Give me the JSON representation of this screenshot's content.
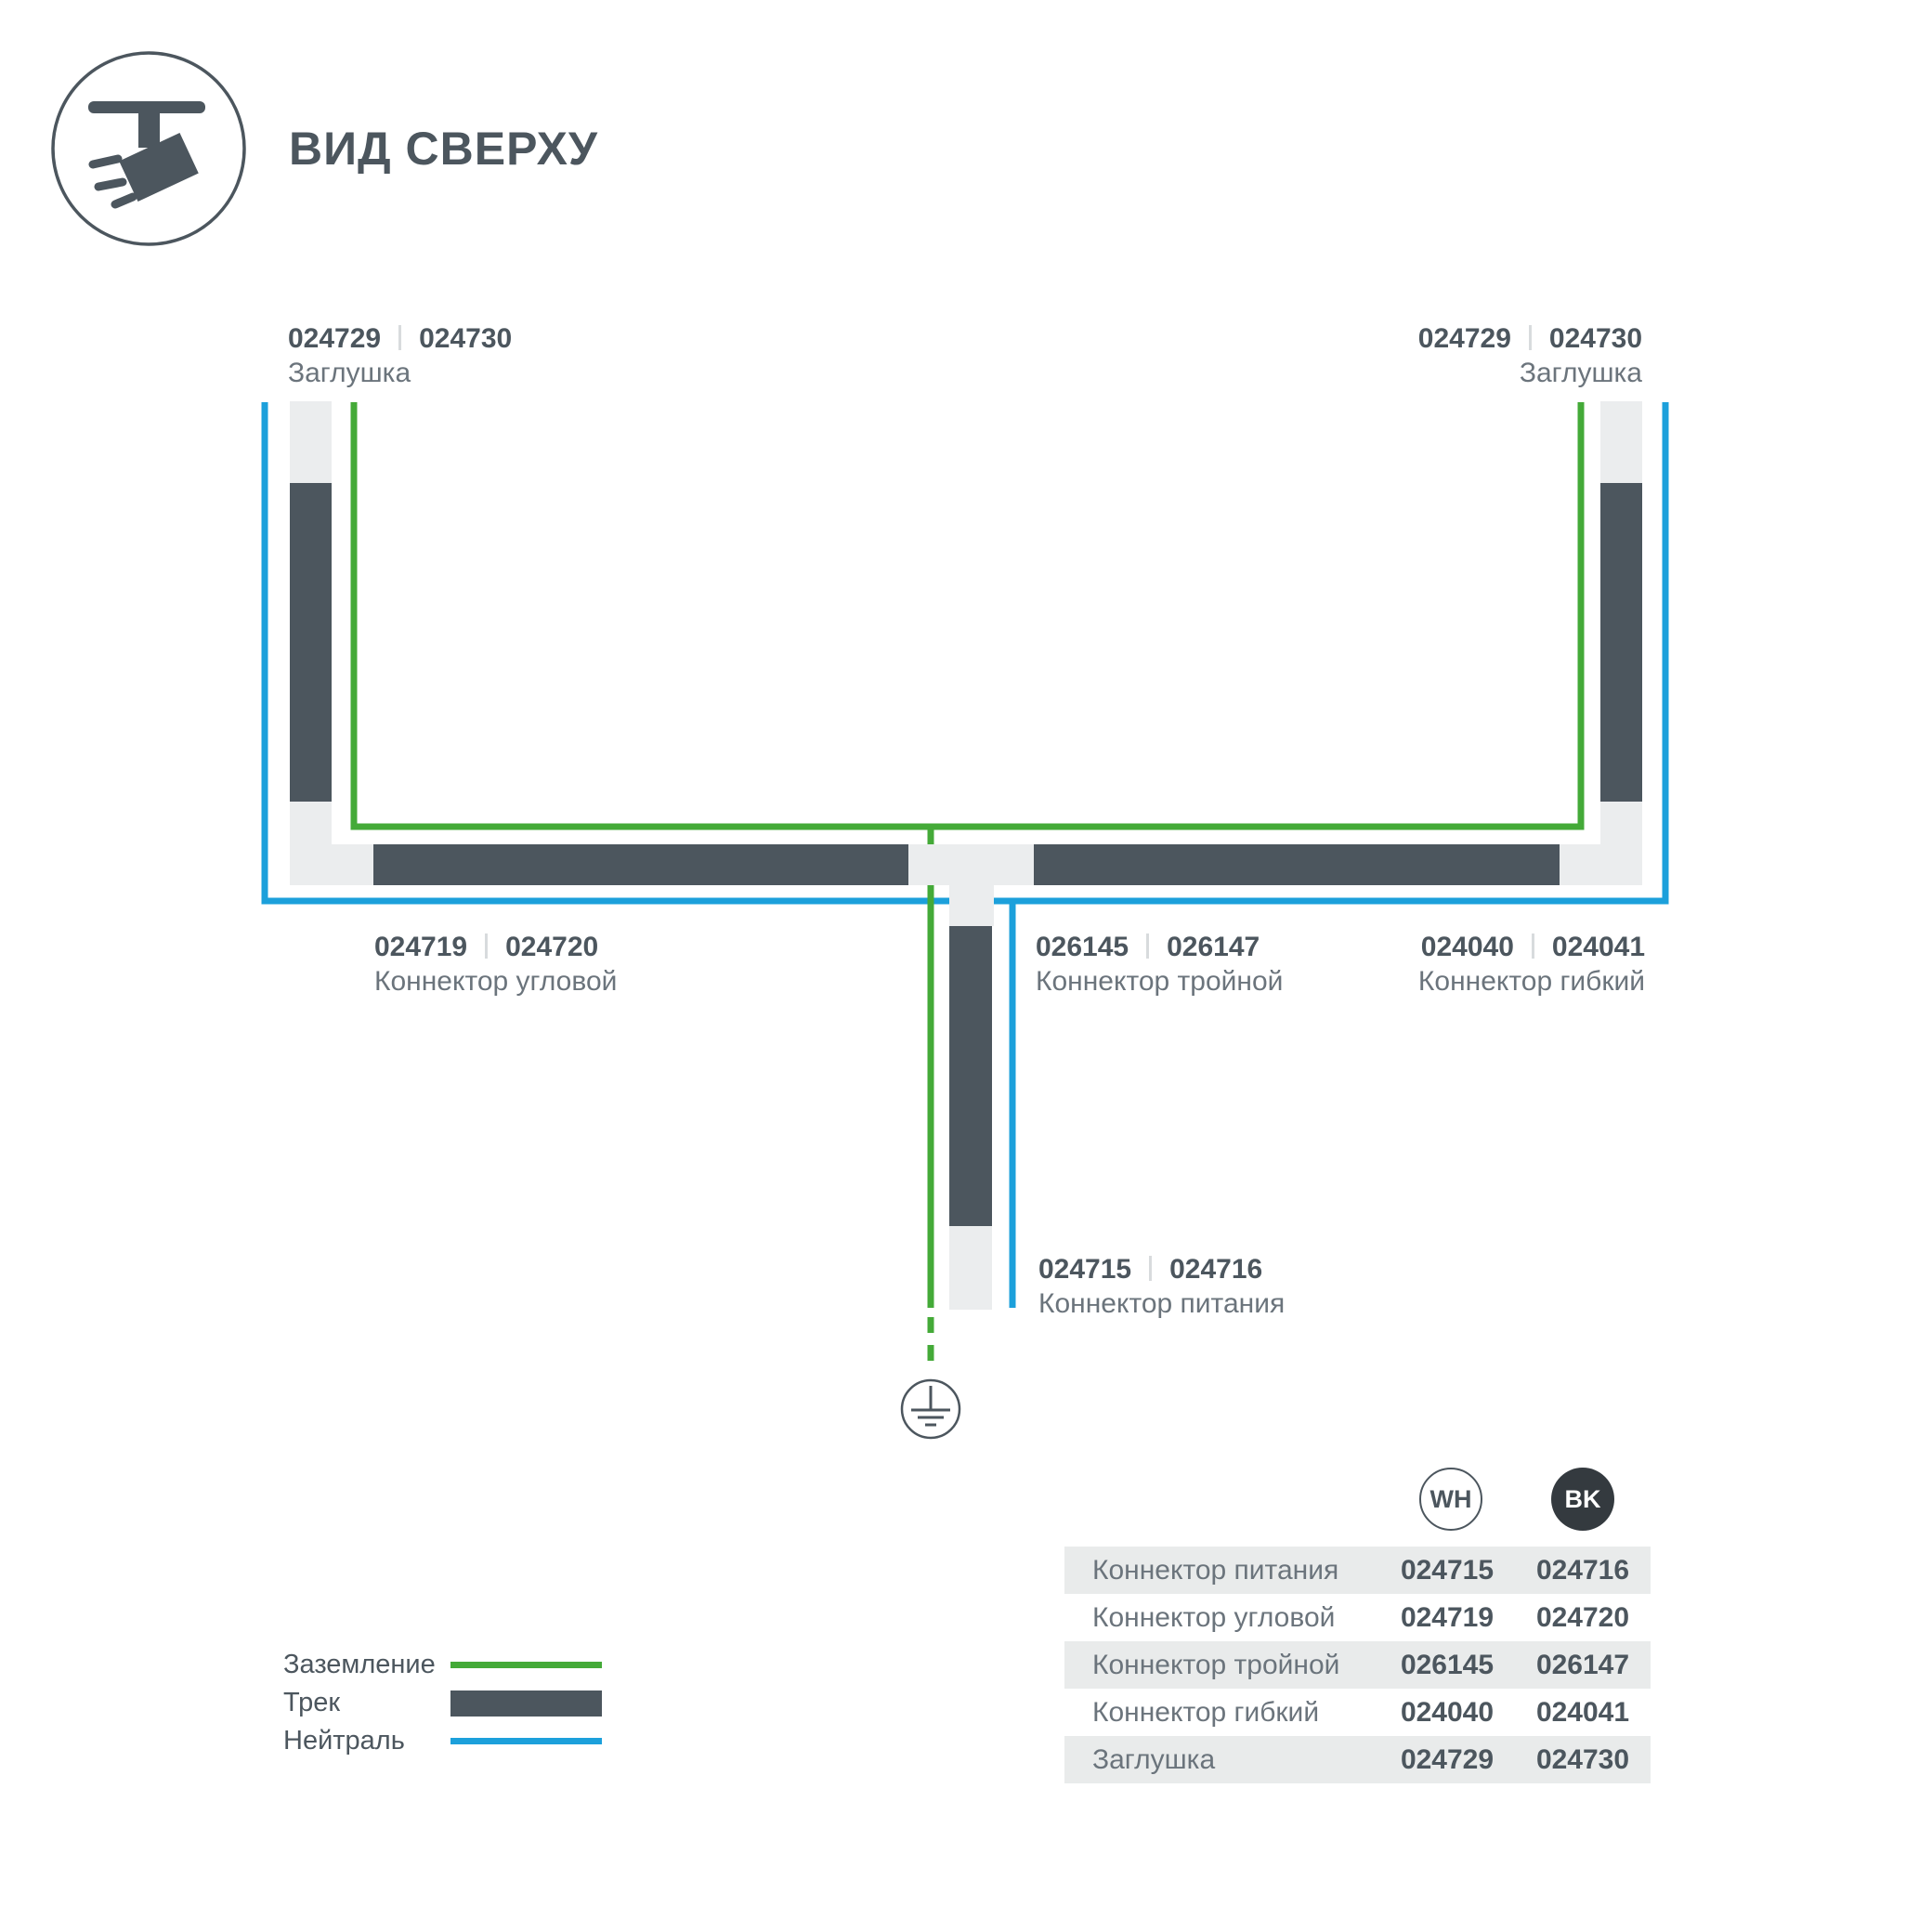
{
  "header": {
    "title": "ВИД СВЕРХУ"
  },
  "colors": {
    "track": "#4C565E",
    "text_primary": "#4C565E",
    "text_secondary": "#6B747C",
    "ground_green": "#44AA38",
    "neutral_blue": "#1CA0DB",
    "connector": "#EBEDEE",
    "row_bg": "#E9EBEB",
    "bk_fill": "#343A3F",
    "separator": "#D8DBDD"
  },
  "parts": {
    "endcap_left": {
      "wh": "024729",
      "bk": "024730",
      "name": "Заглушка"
    },
    "endcap_right": {
      "wh": "024729",
      "bk": "024730",
      "name": "Заглушка"
    },
    "corner": {
      "wh": "024719",
      "bk": "024720",
      "name": "Коннектор угловой"
    },
    "triple": {
      "wh": "026145",
      "bk": "026147",
      "name": "Коннектор тройной"
    },
    "flex": {
      "wh": "024040",
      "bk": "024041",
      "name": "Коннектор гибкий"
    },
    "power": {
      "wh": "024715",
      "bk": "024716",
      "name": "Коннектор питания"
    }
  },
  "legend": {
    "ground": "Заземление",
    "track": "Трек",
    "neutral": "Нейтраль"
  },
  "table": {
    "header": {
      "wh": "WH",
      "bk": "BK"
    },
    "rows": [
      {
        "name": "Коннектор питания",
        "wh": "024715",
        "bk": "024716"
      },
      {
        "name": "Коннектор угловой",
        "wh": "024719",
        "bk": "024720"
      },
      {
        "name": "Коннектор тройной",
        "wh": "026145",
        "bk": "026147"
      },
      {
        "name": "Коннектор гибкий",
        "wh": "024040",
        "bk": "024041"
      },
      {
        "name": "Заглушка",
        "wh": "024729",
        "bk": "024730"
      }
    ]
  }
}
